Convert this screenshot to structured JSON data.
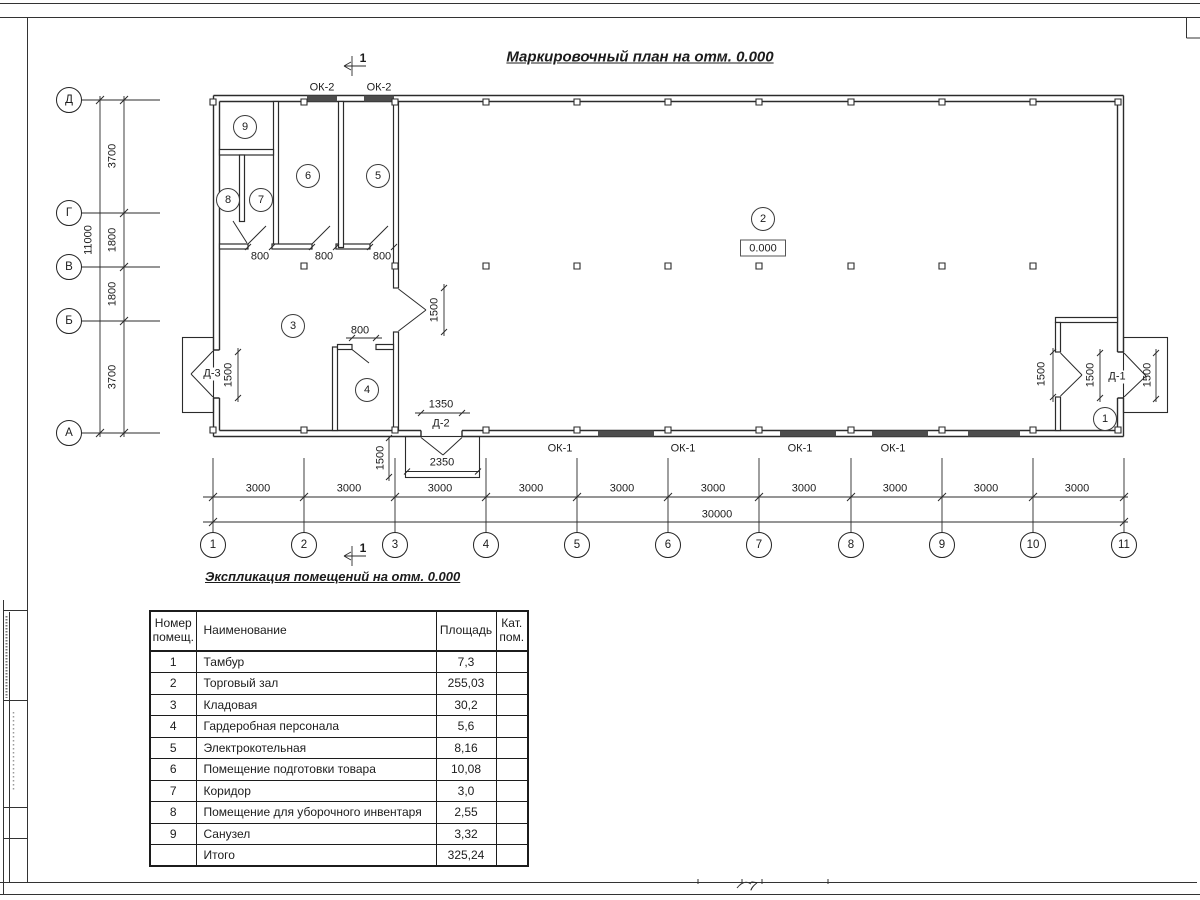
{
  "sheet": {
    "handwritten_mark": "7"
  },
  "plan": {
    "title": "Маркировочный план на отм. 0.000",
    "section_mark_label": "1",
    "elevation_label": "0.000",
    "axes_vertical": [
      "Д",
      "Г",
      "В",
      "Б",
      "А"
    ],
    "axes_horizontal": [
      "1",
      "2",
      "3",
      "4",
      "5",
      "6",
      "7",
      "8",
      "9",
      "10",
      "11"
    ],
    "dim_vertical_total": "11000",
    "dim_vertical_segments": [
      "3700",
      "1800",
      "1800",
      "3700"
    ],
    "dim_horizontal_total": "30000",
    "dim_horizontal_segments": [
      "3000",
      "3000",
      "3000",
      "3000",
      "3000",
      "3000",
      "3000",
      "3000",
      "3000",
      "3000"
    ],
    "window_labels": {
      "ok2": [
        "ОК-2",
        "ОК-2"
      ],
      "ok1": [
        "ОК-1",
        "ОК-1",
        "ОК-1",
        "ОК-1"
      ]
    },
    "door_labels": {
      "d3": "Д-3",
      "d2": "Д-2",
      "d1": "Д-1"
    },
    "detail_dims": {
      "w800": [
        "800",
        "800",
        "800",
        "800"
      ],
      "w1350": "1350",
      "w2350": "2350",
      "w1500": [
        "1500",
        "1500",
        "1500",
        "1500",
        "1500",
        "1500"
      ]
    },
    "room_numbers": [
      "1",
      "2",
      "3",
      "4",
      "5",
      "6",
      "7",
      "8",
      "9"
    ]
  },
  "schedule": {
    "title": "Экспликация помещений на отм. 0.000",
    "headers": {
      "num": "Номер помещ.",
      "name": "Наименование",
      "area": "Площадь",
      "cat": "Кат. пом."
    },
    "rows": [
      {
        "num": "1",
        "name": "Тамбур",
        "area": "7,3",
        "cat": ""
      },
      {
        "num": "2",
        "name": "Торговый зал",
        "area": "255,03",
        "cat": ""
      },
      {
        "num": "3",
        "name": "Кладовая",
        "area": "30,2",
        "cat": ""
      },
      {
        "num": "4",
        "name": "Гардеробная персонала",
        "area": "5,6",
        "cat": ""
      },
      {
        "num": "5",
        "name": "Электрокотельная",
        "area": "8,16",
        "cat": ""
      },
      {
        "num": "6",
        "name": "Помещение подготовки товара",
        "area": "10,08",
        "cat": ""
      },
      {
        "num": "7",
        "name": "Коридор",
        "area": "3,0",
        "cat": ""
      },
      {
        "num": "8",
        "name": "Помещение для уборочного инвентаря",
        "area": "2,55",
        "cat": ""
      },
      {
        "num": "9",
        "name": "Санузел",
        "area": "3,32",
        "cat": ""
      },
      {
        "num": "",
        "name": "Итого",
        "area": "325,24",
        "cat": ""
      }
    ]
  }
}
